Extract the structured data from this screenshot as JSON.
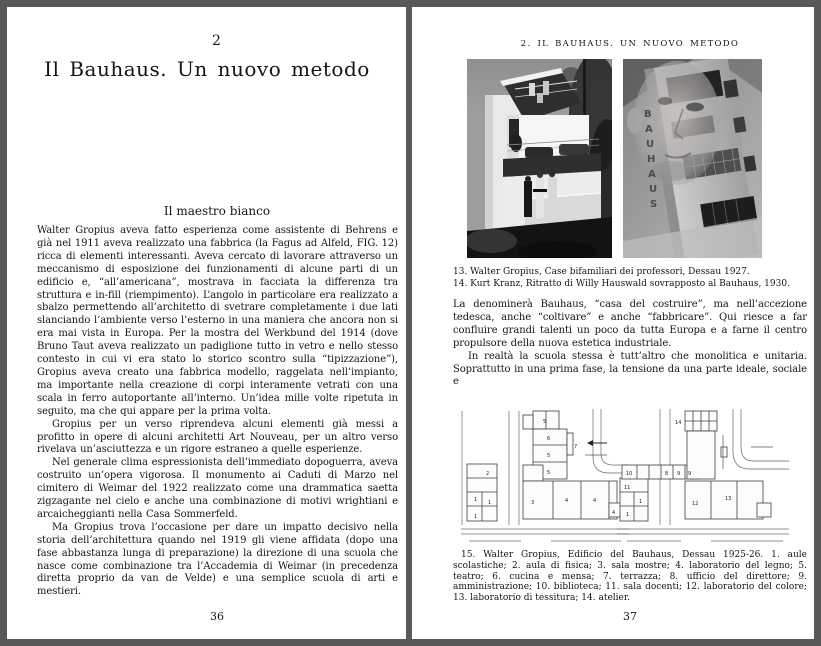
{
  "left_page": {
    "chapter_number": "2",
    "chapter_title": "Il Bauhaus. Un nuovo metodo",
    "section_heading": "Il maestro bianco",
    "paragraphs": [
      "Walter Gropius aveva fatto esperienza come assistente di Behrens e già nel 1911 aveva realizzato una fabbrica (la Fagus ad Alfeld, FIG. 12) ricca di elementi interessanti. Aveva cercato di lavorare attraverso un meccanismo di esposizione dei funzionamenti di alcune parti di un edificio e, “all’americana”, mostrava in facciata la differenza tra struttura e in-fill (riempimento). L’angolo in particolare era realizzato a sbalzo permettendo all’architetto di svetrare completamente i due lati slanciando l’ambiente verso l’esterno in una maniera che ancora non si era mai vista in Europa. Per la mostra del Werkbund del 1914 (dove Bruno Taut aveva realizzato un padiglione tutto in vetro e nello stesso contesto in cui vi era stato lo storico scontro sulla “tipizzazione”), Gropius aveva creato una fabbrica modello, raggelata nell’impianto, ma importante nella creazione di corpi interamente vetrati con una scala in ferro autoportante all’interno. Un’idea mille volte ripetuta in seguito, ma che qui appare per la prima volta.",
      "Gropius per un verso riprendeva alcuni elementi già messi a profitto in opere di alcuni architetti Art Nouveau, per un altro verso rivelava un’asciuttezza e un rigore estraneo a quelle esperienze.",
      "Nel generale clima espressionista dell’immediato dopoguerra, aveva costruito un’opera vigorosa. Il monumento ai Caduti di Marzo nel cimitero di Weimar del 1922 realizzato come una drammatica saetta zigzagante nel cielo e anche una combinazione di motivi wrightiani e arcaicheggianti nella Casa Sommerfeld.",
      "Ma Gropius trova l’occasione per dare un impatto decisivo nella storia dell’architettura quando nel 1919 gli viene affidata (dopo una fase abbastanza lunga di preparazione) la direzione di una scuola che nasce come combinazione tra l’Accademia di Weimar (in precedenza diretta proprio da van de Velde) e una semplice scuola di arti e mestieri."
    ],
    "page_number": "36"
  },
  "right_page": {
    "running_header": "2. IL BAUHAUS. UN NUOVO METODO",
    "photo_captions": [
      "13. Walter Gropius, Case bifamiliari dei professori, Dessau 1927.",
      "14. Kurt Kranz, Ritratto di Willy Hauswald sovrapposto al Bauhaus, 1930."
    ],
    "bauhaus_letters": [
      "B",
      "A",
      "U",
      "H",
      "A",
      "U",
      "S"
    ],
    "paragraphs": [
      "La denominerà Bauhaus, “casa del costruire”, ma nell’accezione tedesca, anche “coltivare” e anche “fabbricare”. Qui riesce a far confluire grandi talenti un poco da tutta Europa e a farne il centro propulsore della nuova estetica industriale.",
      "In realtà la scuola stessa è tutt’altro che monolitica e unitaria. Soprattutto in una prima fase, la tensione da una parte ideale, sociale e"
    ],
    "plan": {
      "left_labels": [
        "2",
        "1",
        "1",
        "1",
        "5",
        "6",
        "5",
        "5",
        "7",
        "3",
        "4",
        "4",
        "4"
      ],
      "right_labels": [
        "14",
        "10",
        "8",
        "9",
        "9",
        "11",
        "1",
        "1",
        "12",
        "13"
      ]
    },
    "plan_caption": "15. Walter Gropius, Edificio del Bauhaus, Dessau 1925-26. 1. aule scolastiche; 2. aula di fisica; 3. sala mostre; 4. laboratorio del legno; 5. teatro; 6. cucina e mensa; 7. terrazza; 8. ufficio del direttore; 9. amministrazione; 10. biblioteca; 11. sala docenti; 12. laboratorio del colore; 13. laboratorio di tessitura; 14. atelier.",
    "page_number": "37"
  }
}
